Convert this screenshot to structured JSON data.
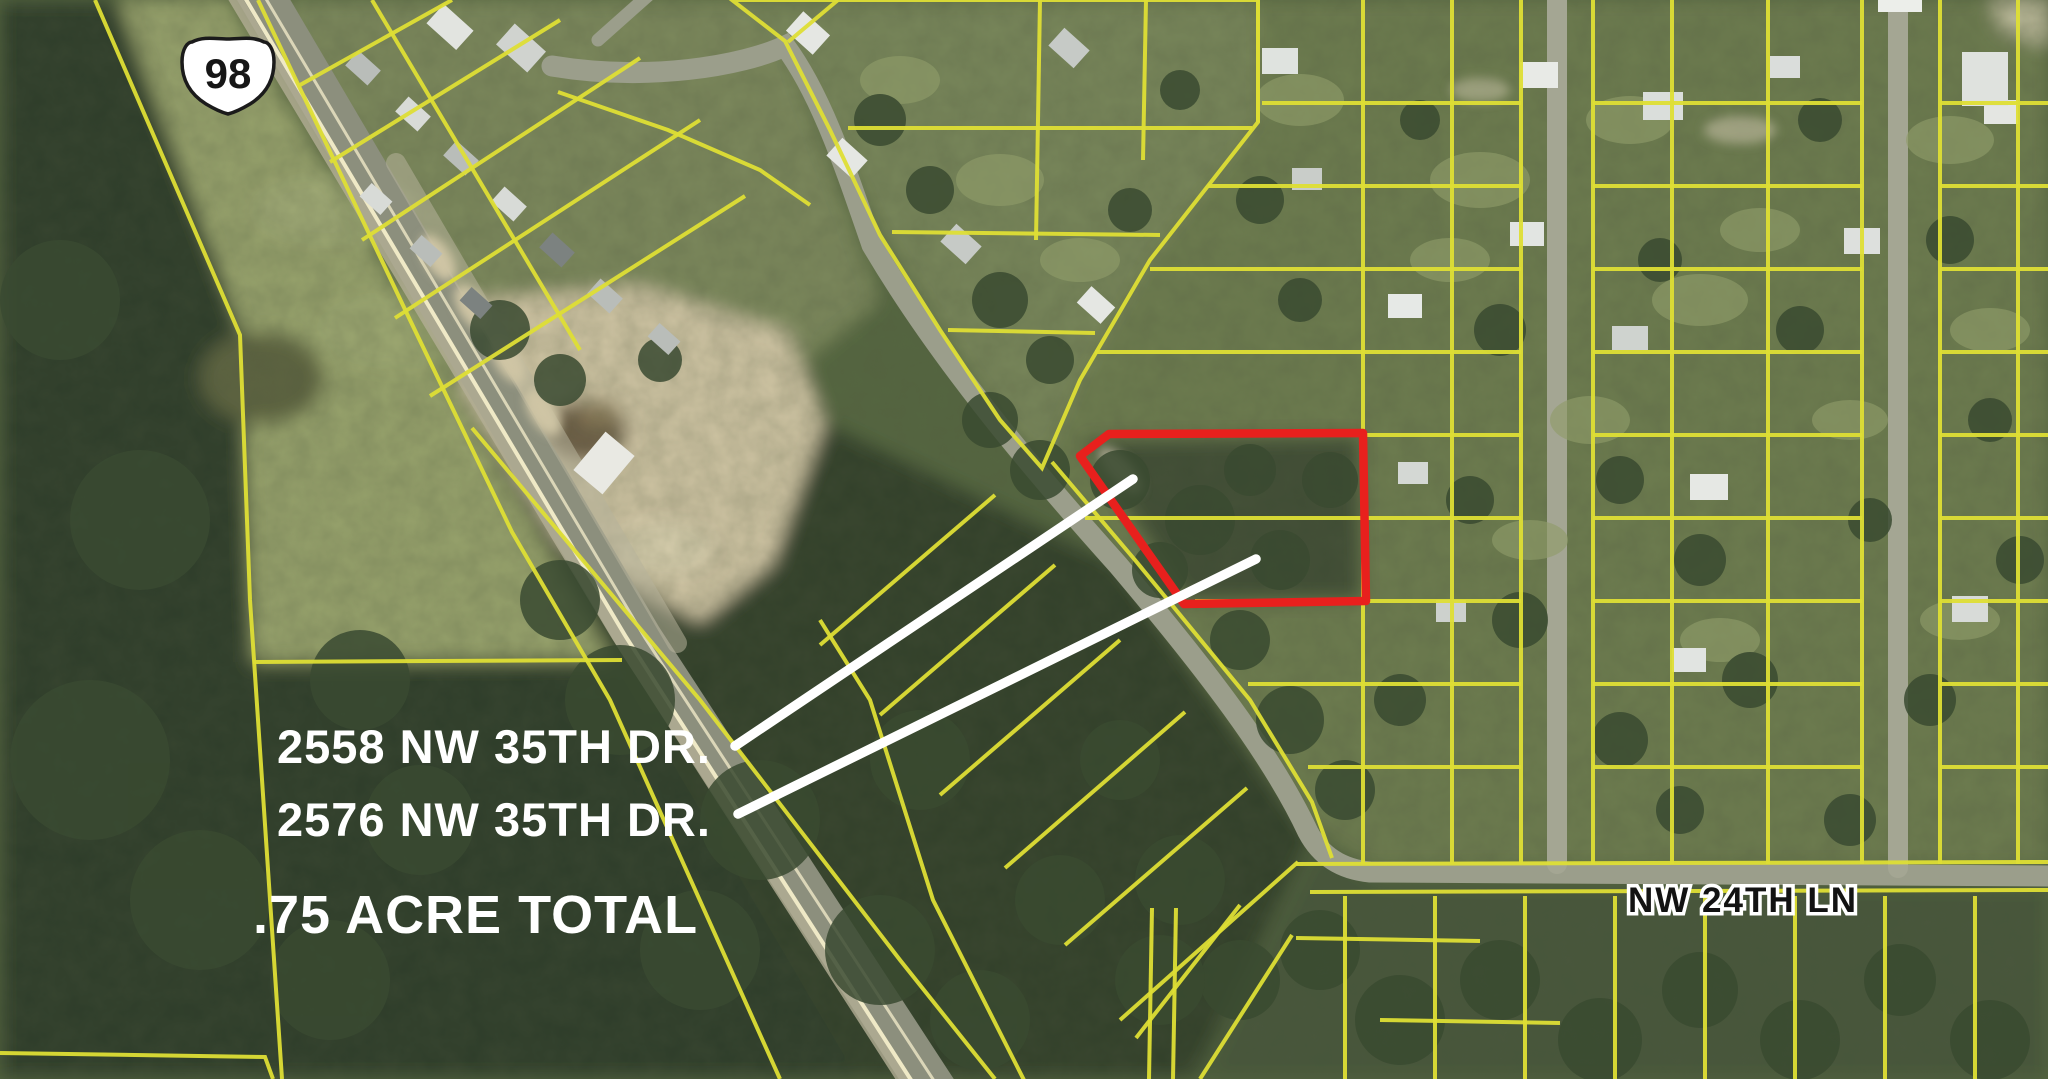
{
  "map": {
    "highway_shield": {
      "route": "98"
    },
    "labels": {
      "address_line1": {
        "text": "2558 NW 35TH DR.",
        "x": 277,
        "y": 763
      },
      "address_line2": {
        "text": "2576 NW 35TH DR.",
        "x": 277,
        "y": 836
      },
      "acreage": {
        "text": ".75 ACRE TOTAL",
        "x": 253,
        "y": 933
      },
      "street": {
        "text": "NW 24TH LN",
        "x": 1628,
        "y": 912
      }
    },
    "red_parcel": {
      "points": "1109,434 1363,433 1366,601 1184,604 1080,456",
      "color": "#e8201d"
    },
    "leader_lines": [
      {
        "x1": 735,
        "y1": 746,
        "x2": 1133,
        "y2": 479
      },
      {
        "x1": 738,
        "y1": 814,
        "x2": 1256,
        "y2": 559
      }
    ],
    "colors": {
      "parcel_line": "#dede35",
      "annotation_red": "#e8201d",
      "leader_white": "#ffffff",
      "shield_fill": "#ffffff",
      "shield_text": "#161616"
    }
  }
}
